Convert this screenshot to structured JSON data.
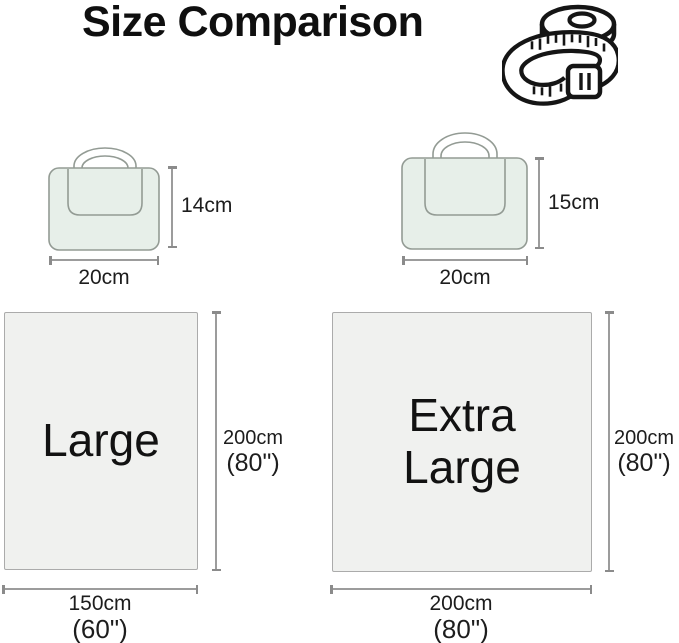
{
  "title": "Size Comparison",
  "icons": {
    "tape_measure": "measuring-tape"
  },
  "colors": {
    "background": "#ffffff",
    "bag_fill": "#e7efe9",
    "bag_stroke": "#939b94",
    "blanket_fill": "#f0f1ef",
    "blanket_border": "#ababab",
    "dimension_line": "#9c9c9c",
    "text": "#1b1b1b",
    "icon_stroke": "#151515"
  },
  "bags": {
    "small": {
      "height": "14cm",
      "width": "20cm"
    },
    "large": {
      "height": "15cm",
      "width": "20cm"
    }
  },
  "blankets": {
    "large": {
      "label": "Large",
      "height_cm": "200cm",
      "height_in": "(80\")",
      "width_cm": "150cm",
      "width_in": "(60\")"
    },
    "extra_large": {
      "label_line1": "Extra",
      "label_line2": "Large",
      "height_cm": "200cm",
      "height_in": "(80\")",
      "width_cm": "200cm",
      "width_in": "(80\")"
    }
  }
}
